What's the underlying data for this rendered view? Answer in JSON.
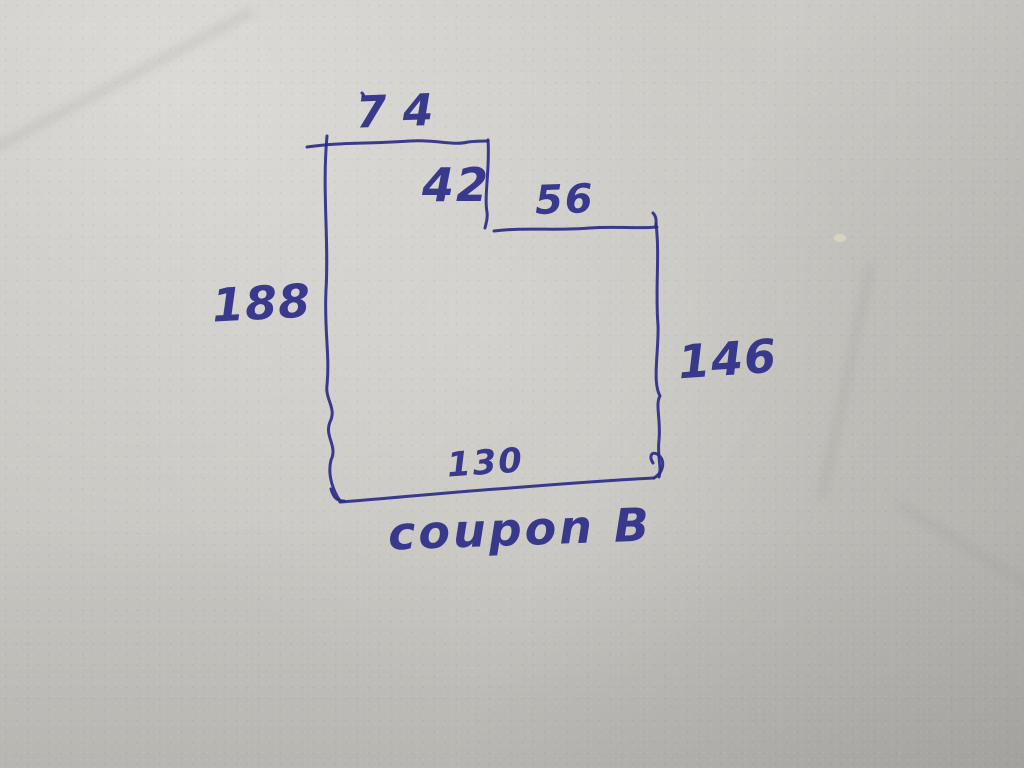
{
  "figure": {
    "type": "hand-drawn dimensioned sketch of an L-shaped (notched rectangle) coupon",
    "caption": "coupon B",
    "dimensions": {
      "top_left_edge": "74",
      "notch_depth": "42",
      "top_right_edge": "56",
      "left_edge": "188",
      "right_edge": "146",
      "bottom_edge": "130"
    }
  },
  "colors": {
    "pen": "#2d2d88",
    "paper": "#c9c7c2"
  }
}
